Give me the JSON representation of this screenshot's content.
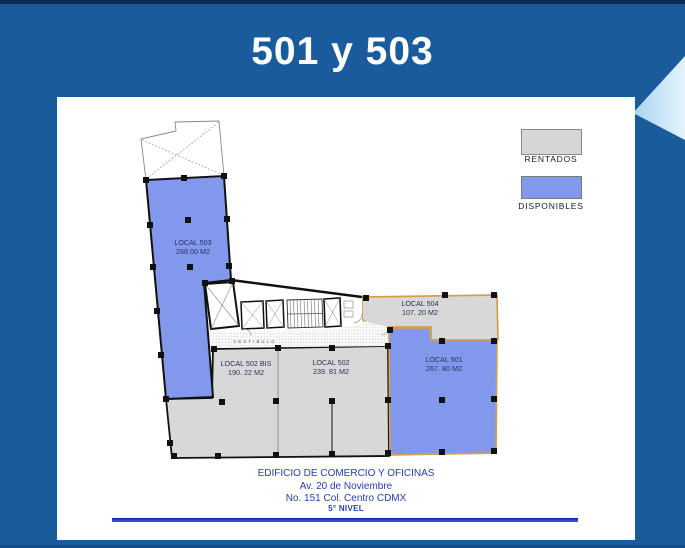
{
  "title": "501 y 503",
  "colors": {
    "background": "#1A5B9C",
    "top_strip": "#0D2B50",
    "panel": "#FFFFFF",
    "available_fill": "#8298EC",
    "rented_fill": "#D8D8D8",
    "highlight_border": "#D2A04C",
    "plan_outline": "#111111",
    "accent_line_blue": "#2E50D6",
    "address_text": "#2840A8",
    "triangle_light_blue": "#CDE7FA"
  },
  "legend": {
    "items": [
      {
        "label": "RENTADOS",
        "color": "#D6D6D6",
        "meaning": "rented"
      },
      {
        "label": "DISPONIBLES",
        "color": "#8298EC",
        "meaning": "available"
      }
    ]
  },
  "plan": {
    "vestibule_label": "VESTIBULO",
    "locals": [
      {
        "id": "local-503",
        "name": "LOCAL 503",
        "area": "268.00 M2",
        "status": "disponible"
      },
      {
        "id": "local-504",
        "name": "LOCAL 504",
        "area": "107. 20 M2",
        "status": "rentado"
      },
      {
        "id": "local-502-bis",
        "name": "LOCAL 502 BIS",
        "area": "190. 22 M2",
        "status": "rentado"
      },
      {
        "id": "local-502",
        "name": "LOCAL 502",
        "area": "239. 81 M2",
        "status": "rentado"
      },
      {
        "id": "local-501",
        "name": "LOCAL 501",
        "area": "267. 80 M2",
        "status": "disponible"
      }
    ]
  },
  "footer": {
    "line1": "EDIFICIO DE COMERCIO Y OFICINAS",
    "line2": "Av.  20 de Noviembre",
    "line3": "No. 151  Col. Centro  CDMX",
    "level": "5° NIVEL"
  }
}
